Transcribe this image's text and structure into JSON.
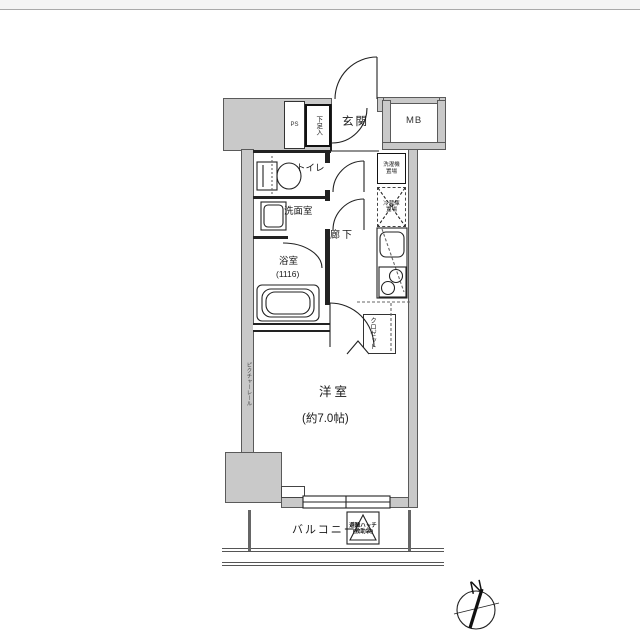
{
  "page": {
    "top_strip_color": "#f4f4f4",
    "background": "#ffffff",
    "wall_color": "#c9c9c9",
    "line_color": "#222222"
  },
  "rooms": {
    "genkan": {
      "label": "玄関"
    },
    "ps": {
      "label": "PS"
    },
    "shoe_cabinet": {
      "label": "下足入"
    },
    "mb": {
      "label": "MB"
    },
    "toilet": {
      "label": "トイレ"
    },
    "washroom": {
      "label": "洗面室"
    },
    "bathroom": {
      "label": "浴室",
      "size": "(1116)"
    },
    "hallway": {
      "label": "廊下"
    },
    "laundry": {
      "line1": "洗濯機",
      "line2": "置場"
    },
    "fridge": {
      "line1": "冷蔵庫",
      "line2": "置場"
    },
    "closet": {
      "label": "クロゼット"
    },
    "western_room": {
      "label": "洋室",
      "size": "(約7.0帖)"
    },
    "picture_rail": {
      "label": "ピクチャーレール"
    },
    "balcony": {
      "label": "バルコニー"
    },
    "hatch": {
      "line1": "避難ハッチ",
      "line2": "(救助袋)"
    },
    "compass": {
      "label": "N"
    }
  }
}
